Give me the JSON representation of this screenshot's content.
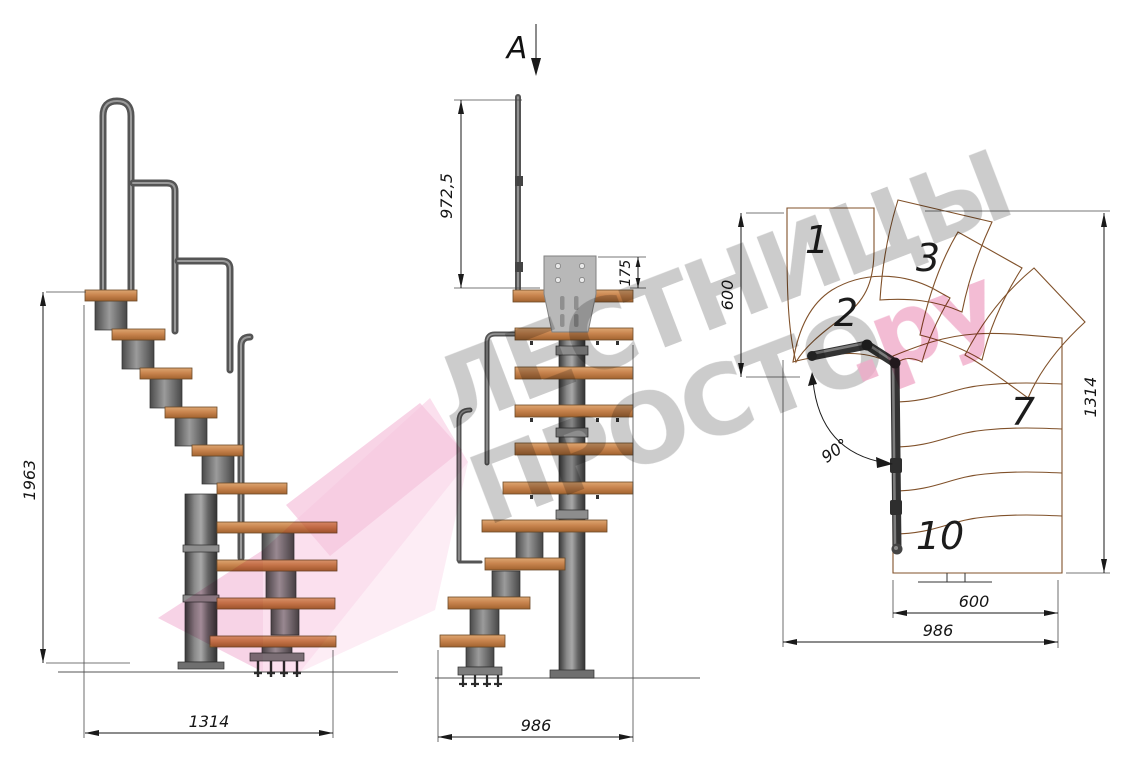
{
  "document": {
    "type": "staircase technical drawing",
    "views": [
      "side elevation",
      "front elevation",
      "top plan"
    ]
  },
  "section_marker": {
    "label": "A"
  },
  "side_view": {
    "height_label": "1963",
    "length_label": "1314"
  },
  "front_view": {
    "rail_height_label": "972,5",
    "bracket_label": "175",
    "width_label": "986"
  },
  "plan_view": {
    "upper_width_label": "600",
    "depth_label": "1314",
    "angle_label": "90°",
    "flight_width_label": "600",
    "total_width_label": "986",
    "step_labels": [
      "1",
      "2",
      "3",
      "7",
      "10"
    ]
  },
  "watermark": {
    "line1": "ЛЕСТНИЦЫ",
    "line2": "ПРОСТО",
    "accent": ".ру"
  },
  "colors": {
    "wood": "#cf9462",
    "wood_edge": "#80512a",
    "metal_dark": "#3e3e3e",
    "metal_light": "#a5a5a5",
    "steel_plate": "#b8b8b8",
    "dim_line": "#1a1a1a",
    "watermark_gray": "#8f8f8f",
    "watermark_pink": "#e4679c",
    "logo_pink": "#f0a6cc"
  }
}
